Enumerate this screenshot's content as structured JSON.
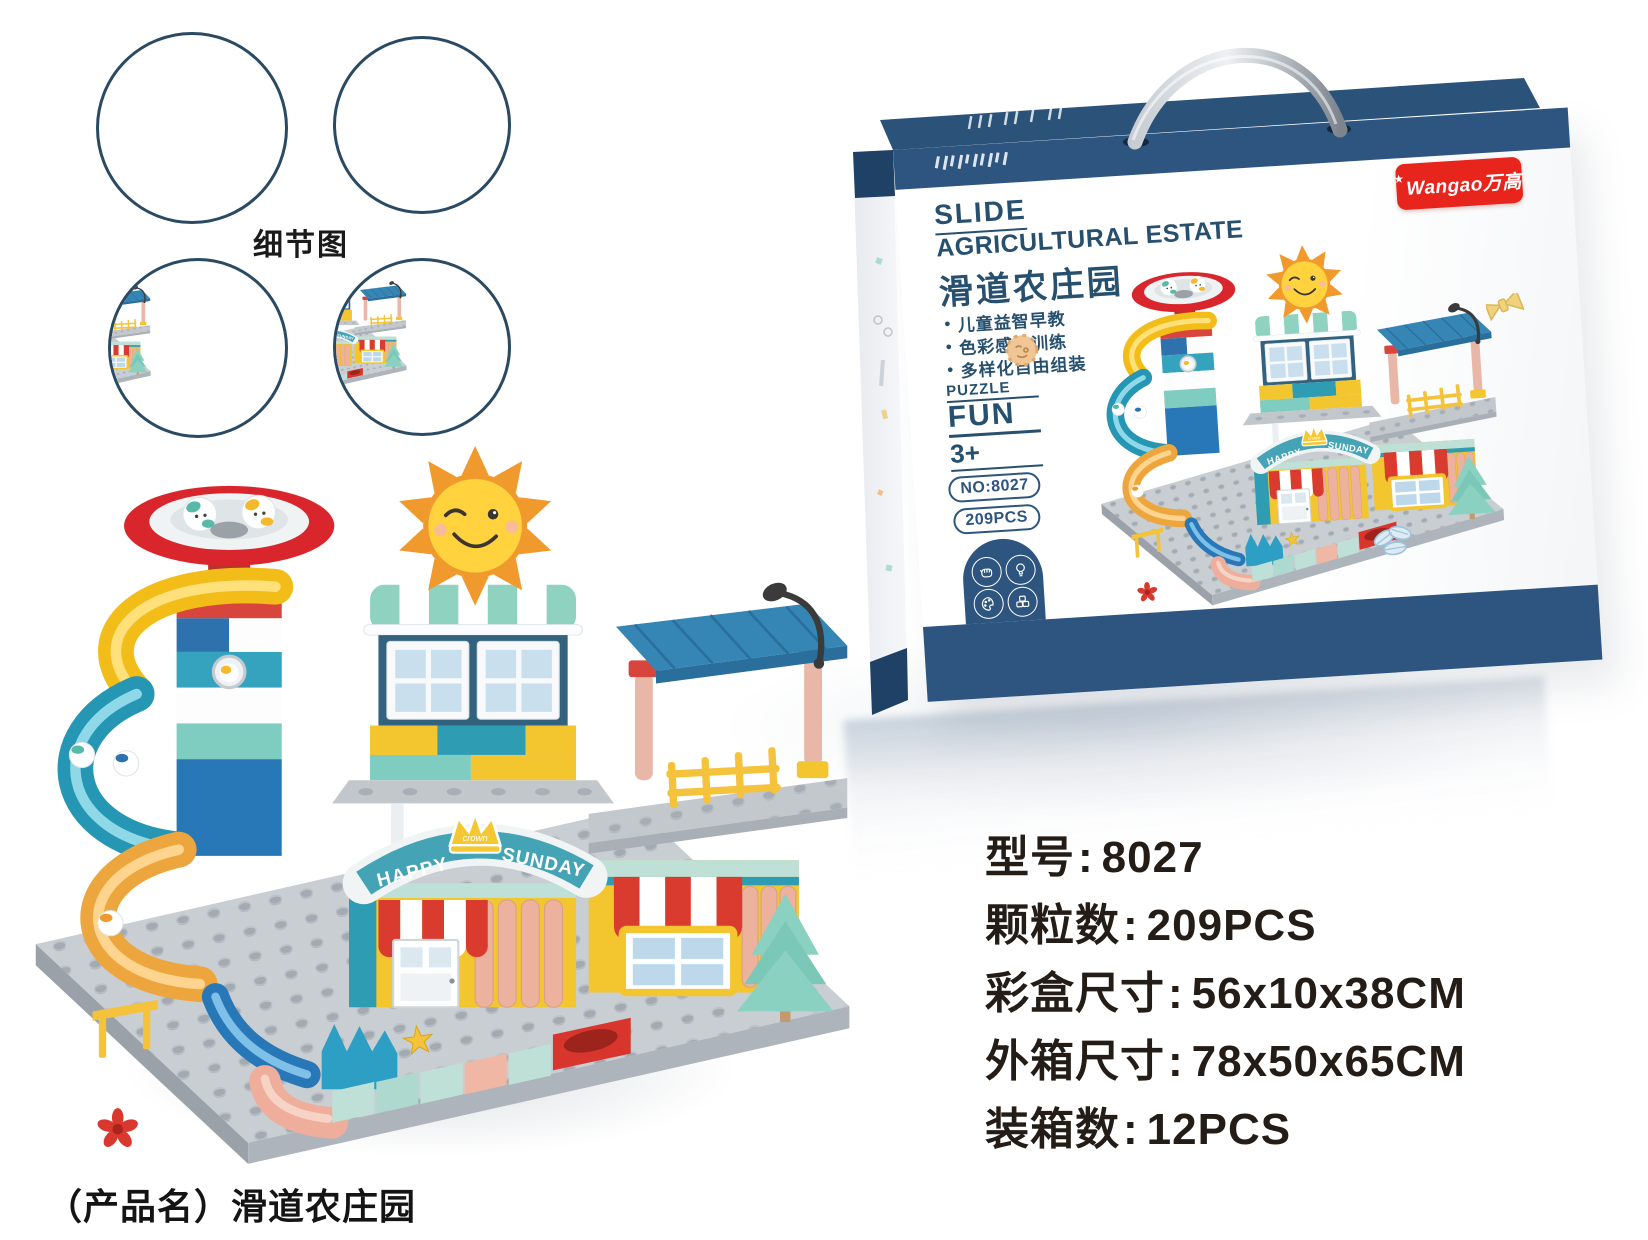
{
  "page": {
    "width": 1648,
    "height": 1240,
    "background": "#ffffff"
  },
  "detail_section": {
    "label": "细节图",
    "border_color": "#2a4a63",
    "circles": [
      {
        "name": "house-front-detail"
      },
      {
        "name": "sunday-sign-detail"
      },
      {
        "name": "sun-roof-detail"
      },
      {
        "name": "funnel-balls-detail"
      }
    ]
  },
  "toy": {
    "banner_happy": "HAPPY",
    "banner_sunday": "SUNDAY",
    "crown_text": "crown",
    "colors": {
      "baseplate": "#c9ced3",
      "funnel_red": "#d8262c",
      "slide_yellow": "#f3bd19",
      "slide_teal": "#2596b4",
      "slide_amber": "#eda63e",
      "roof_blue": "#3585b5",
      "awning_red": "#da3b2f",
      "wall_yellow": "#f3c52f",
      "mint": "#bfe0d6",
      "teal": "#2e9db3",
      "pink": "#ecb29e",
      "sun_yellow": "#ffd23e",
      "sun_orange": "#f09a2e",
      "tree_green": "#8ad1c2"
    }
  },
  "box": {
    "brand": "Wangao万高",
    "logo_star": "★",
    "title_en_line1": "SLIDE",
    "title_en_line2": "AGRICULTURAL ESTATE",
    "title_cn": "滑道农庄园",
    "bullet": "●",
    "features": [
      "儿童益智早教",
      "色彩感知训练",
      "多样化自由组装"
    ],
    "puzzle_label": "PUZZLE",
    "fun_label": "FUN",
    "age_label": "3+",
    "model_pill": "NO:8027",
    "pieces_pill": "209PCS",
    "icons": [
      "hand-icon",
      "bulb-icon",
      "palette-icon",
      "bricks-icon"
    ],
    "colors": {
      "band_navy": "#2d5580",
      "title_navy": "#27506f",
      "logo_red": "#e8251d"
    }
  },
  "specs": {
    "colon": ":",
    "lines": [
      {
        "label": "型号",
        "value": "8027"
      },
      {
        "label": "颗粒数",
        "value": "209PCS"
      },
      {
        "label": "彩盒尺寸",
        "value": "56x10x38CM"
      },
      {
        "label": "外箱尺寸",
        "value": "78x50x65CM"
      },
      {
        "label": "装箱数",
        "value": "12PCS"
      }
    ]
  },
  "product_name": "（产品名）滑道农庄园"
}
